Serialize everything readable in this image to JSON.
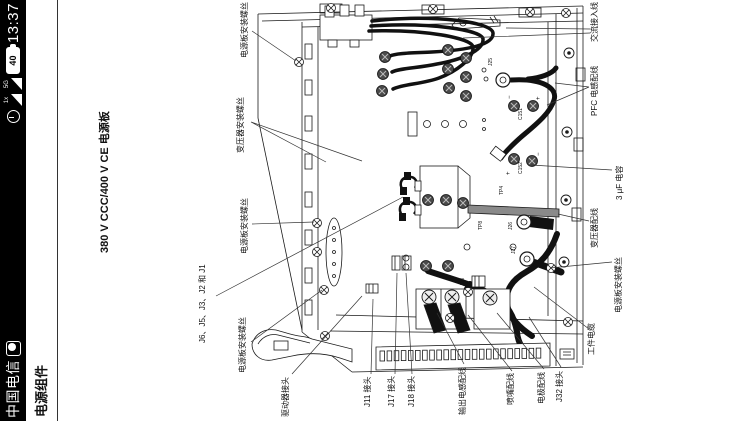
{
  "colors": {
    "statusbar_bg": "#000000",
    "page_bg": "#ffffff",
    "line": "#1a1a1a"
  },
  "status_bar": {
    "carrier": "中国电信",
    "time": "13:37",
    "battery_percent": "40",
    "signals": [
      {
        "label": "1x"
      },
      {
        "label": "5G"
      }
    ]
  },
  "header": {
    "section_title": "电源组件"
  },
  "figure": {
    "title": "380 V CCC/400 V CE 电源板",
    "callouts": [
      {
        "text": "电源板安装螺丝",
        "x": 363,
        "y": 240
      },
      {
        "text": "变压器安装螺丝",
        "x": 268,
        "y": 236
      },
      {
        "text": "电源板安装螺丝",
        "x": 167,
        "y": 240
      },
      {
        "text": "J6、J5、J3、J2 和 J1",
        "x": 78,
        "y": 198
      },
      {
        "text": "电源板安装螺丝",
        "x": 48,
        "y": 238
      },
      {
        "text": "驱动器接头",
        "x": 4,
        "y": 281
      },
      {
        "text": "J11 接头",
        "x": 14,
        "y": 363
      },
      {
        "text": "J17 接头",
        "x": 14,
        "y": 387
      },
      {
        "text": "J18 接头",
        "x": 14,
        "y": 407
      },
      {
        "text": "输出电感配线",
        "x": 6,
        "y": 458
      },
      {
        "text": "喷嘴配线",
        "x": 16,
        "y": 506
      },
      {
        "text": "电极配线",
        "x": 17,
        "y": 537
      },
      {
        "text": "J32 接头",
        "x": 19,
        "y": 555
      },
      {
        "text": "工件电缆",
        "x": 66,
        "y": 587
      },
      {
        "text": "电源板安装螺丝",
        "x": 108,
        "y": 614
      },
      {
        "text": "变压器配线",
        "x": 173,
        "y": 590
      },
      {
        "text": "3 μF 电容",
        "x": 221,
        "y": 615
      },
      {
        "text": "PFC 电感配线",
        "x": 305,
        "y": 590
      },
      {
        "text": "交流接入线",
        "x": 379,
        "y": 590
      }
    ],
    "refs": {
      "j25": "J25",
      "c151": "C151",
      "c152": "C152",
      "j26": "J26",
      "j27": "J27",
      "j28": "J28",
      "tp8": "TP8",
      "tp4": "TP4",
      "plus": "+",
      "minus": "−"
    }
  }
}
